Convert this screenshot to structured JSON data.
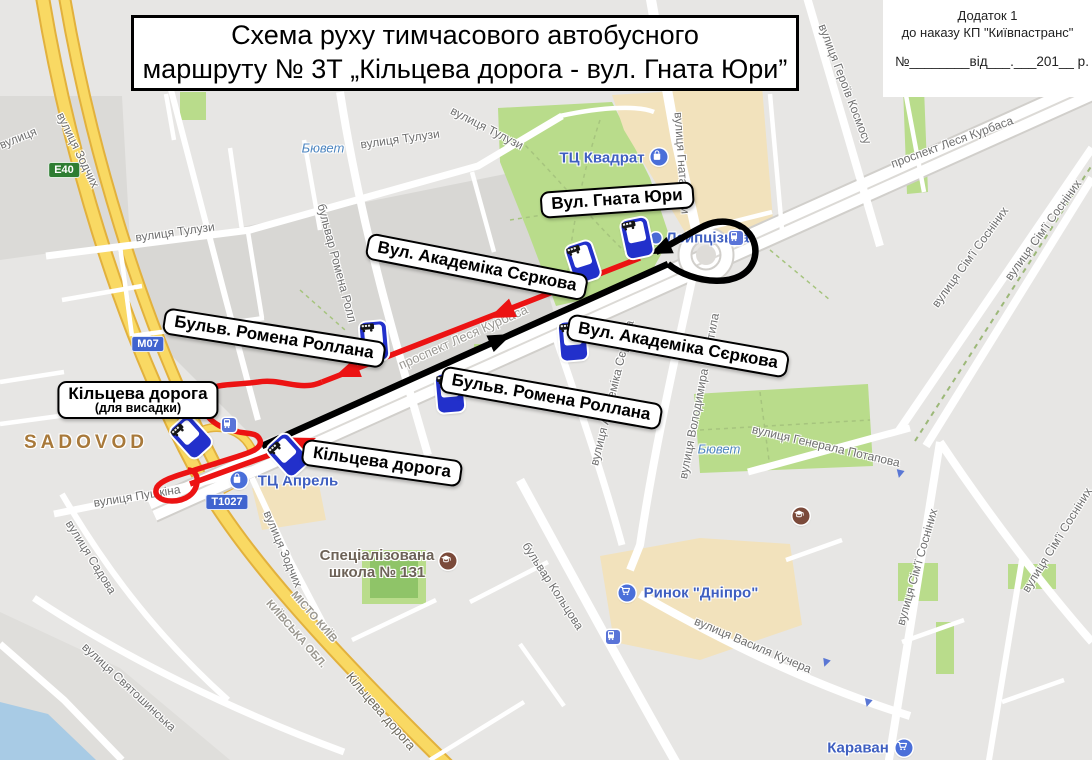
{
  "title": {
    "line1": "Схема руху тимчасового автобусного",
    "line2": "маршруту № 3Т „Кільцева дорога - вул. Гната Юри”"
  },
  "annex": {
    "line1": "Додаток 1",
    "line2": "до наказу КП \"Київпастранс\"",
    "line3": "№________від___.___201__ р."
  },
  "colors": {
    "route_forward": "#000000",
    "route_return": "#ec1313",
    "bus_stop_blue": "#2230cb",
    "poi_blue": "#4a6fd9",
    "poi_brown": "#7b4a3a",
    "road_yellow": "#f9d963",
    "park_green": "#b9dc8b",
    "badge_green": "#2e7d32",
    "badge_blue": "#4064cf"
  },
  "callouts": [
    {
      "t": "Вул. Гната Юри",
      "x": 617,
      "y": 200,
      "r": -4
    },
    {
      "t": "Вул. Академіка Сєркова",
      "x": 477,
      "y": 267,
      "r": 11
    },
    {
      "t": "Бульв. Ромена Роллана",
      "x": 274,
      "y": 338,
      "r": 9
    },
    {
      "t": "Кільцева дорога",
      "sub": "(для висадки)",
      "x": 138,
      "y": 400,
      "r": 0
    },
    {
      "t": "Вул. Академіка Сєркова",
      "x": 678,
      "y": 346,
      "r": 10
    },
    {
      "t": "Бульв. Ромена Роллана",
      "x": 551,
      "y": 398,
      "r": 10
    },
    {
      "t": "Кільцева дорога",
      "x": 382,
      "y": 463,
      "r": 8
    }
  ],
  "bus_stops": [
    {
      "x": 583,
      "y": 262,
      "r": -18
    },
    {
      "x": 637,
      "y": 238,
      "r": -12
    },
    {
      "x": 374,
      "y": 341,
      "r": -5
    },
    {
      "x": 573,
      "y": 341,
      "r": -5
    },
    {
      "x": 450,
      "y": 393,
      "r": -5
    },
    {
      "x": 191,
      "y": 437,
      "r": -42
    },
    {
      "x": 288,
      "y": 455,
      "r": -42
    }
  ],
  "badges": [
    {
      "t": "E40",
      "x": 64,
      "y": 170,
      "kind": "green"
    },
    {
      "t": "М07",
      "x": 148,
      "y": 344,
      "kind": "blue"
    },
    {
      "t": "Т1027",
      "x": 227,
      "y": 502,
      "kind": "blue"
    }
  ],
  "pois": [
    {
      "t": "ТЦ Квадрат",
      "lx": 602,
      "ly": 158,
      "icon": "bag",
      "ix": 659,
      "iy": 157
    },
    {
      "t": "Лейпцізька",
      "lx": 666,
      "ly": 238,
      "anchor": "left",
      "icon": "dot",
      "ix": 656,
      "iy": 238
    },
    {
      "t": "ТЦ Апрель",
      "lx": 298,
      "ly": 481,
      "icon": "bag",
      "ix": 239,
      "iy": 480
    },
    {
      "t": "Ринок \"Дніпро\"",
      "lx": 701,
      "ly": 593,
      "icon": "cart",
      "ix": 627,
      "iy": 593
    },
    {
      "t": "Караван",
      "lx": 858,
      "ly": 748,
      "icon": "cart",
      "ix": 904,
      "iy": 748
    },
    {
      "t": "Спеціалізована\nшкола № 131",
      "lx": 377,
      "ly": 564,
      "icon": "school",
      "ix": 448,
      "iy": 561,
      "c": "#6d6257"
    },
    {
      "t": "",
      "icon": "school",
      "ix": 801,
      "iy": 516
    }
  ],
  "transit_icons": [
    {
      "x": 736,
      "y": 238
    },
    {
      "x": 613,
      "y": 637
    },
    {
      "x": 229,
      "y": 425
    }
  ],
  "streets": [
    {
      "t": "вулиця",
      "x": 18,
      "y": 138,
      "r": -22
    },
    {
      "t": "вулиця Зодчих",
      "x": 78,
      "y": 150,
      "r": 64
    },
    {
      "t": "вулиця Тулузи",
      "x": 175,
      "y": 232,
      "r": -8
    },
    {
      "t": "вулиця Тулузи",
      "x": 400,
      "y": 139,
      "r": -8
    },
    {
      "t": "вулиця Тулузи",
      "x": 487,
      "y": 128,
      "r": 27
    },
    {
      "t": "бульвар Ромена Ролл",
      "x": 337,
      "y": 263,
      "r": 75
    },
    {
      "t": "вулиця Гната Юри",
      "x": 682,
      "y": 163,
      "r": 86
    },
    {
      "t": "вулиця Героїв Космосу",
      "x": 845,
      "y": 84,
      "r": 69
    },
    {
      "t": "проспект Леся Курбаса",
      "x": 952,
      "y": 142,
      "r": -20
    },
    {
      "t": "вулиця Сім'ї Сосніних",
      "x": 970,
      "y": 257,
      "r": -54
    },
    {
      "t": "вулиця Сім'ї Сосніних",
      "x": 1043,
      "y": 230,
      "r": -54
    },
    {
      "t": "проспект Леся Курбаса",
      "x": 463,
      "y": 337,
      "r": -24,
      "fs": 13,
      "c": "#9a9893"
    },
    {
      "t": "вулиця Академіка Сєркова",
      "x": 612,
      "y": 393,
      "r": -76
    },
    {
      "t": "вулиця Володимира Покотила",
      "x": 699,
      "y": 396,
      "r": -79
    },
    {
      "t": "вулиця Генерала Потапова",
      "x": 826,
      "y": 446,
      "r": 13
    },
    {
      "t": "вулиця Сім'ї Сосніних",
      "x": 917,
      "y": 567,
      "r": -74
    },
    {
      "t": "вулиця Сім'ї Сосніних",
      "x": 1057,
      "y": 540,
      "r": -58
    },
    {
      "t": "вулиця Пушкіна",
      "x": 137,
      "y": 496,
      "r": -9
    },
    {
      "t": "вулиця Садова",
      "x": 91,
      "y": 557,
      "r": 58
    },
    {
      "t": "вулиця Святошинська",
      "x": 129,
      "y": 687,
      "r": 43
    },
    {
      "t": "вулиця Зодчих",
      "x": 283,
      "y": 549,
      "r": 67
    },
    {
      "t": "МІСТО КИЇВ",
      "x": 314,
      "y": 617,
      "r": 49,
      "fs": 11,
      "c": "#9b9890",
      "b": 1
    },
    {
      "t": "КИЇВСЬКА ОБЛ.",
      "x": 296,
      "y": 634,
      "r": 49,
      "fs": 11,
      "c": "#9b9890",
      "b": 1
    },
    {
      "t": "Кільцева дорога",
      "x": 381,
      "y": 711,
      "r": 49,
      "fs": 13,
      "c": "#6e6a5e"
    },
    {
      "t": "бульвар Кольцова",
      "x": 553,
      "y": 586,
      "r": 57
    },
    {
      "t": "вулиця Василя Кучера",
      "x": 753,
      "y": 645,
      "r": 23
    },
    {
      "t": "SADOVOD",
      "x": 86,
      "y": 443,
      "r": 0,
      "fs": 19,
      "c": "#a8793a",
      "b": 1,
      "ls": 4
    },
    {
      "t": "Бювет",
      "x": 323,
      "y": 148,
      "r": 0,
      "c": "#4e86c0",
      "i": 1,
      "fs": 13
    },
    {
      "t": "Бювет",
      "x": 719,
      "y": 449,
      "r": 0,
      "c": "#4e86c0",
      "i": 1,
      "fs": 13
    }
  ]
}
